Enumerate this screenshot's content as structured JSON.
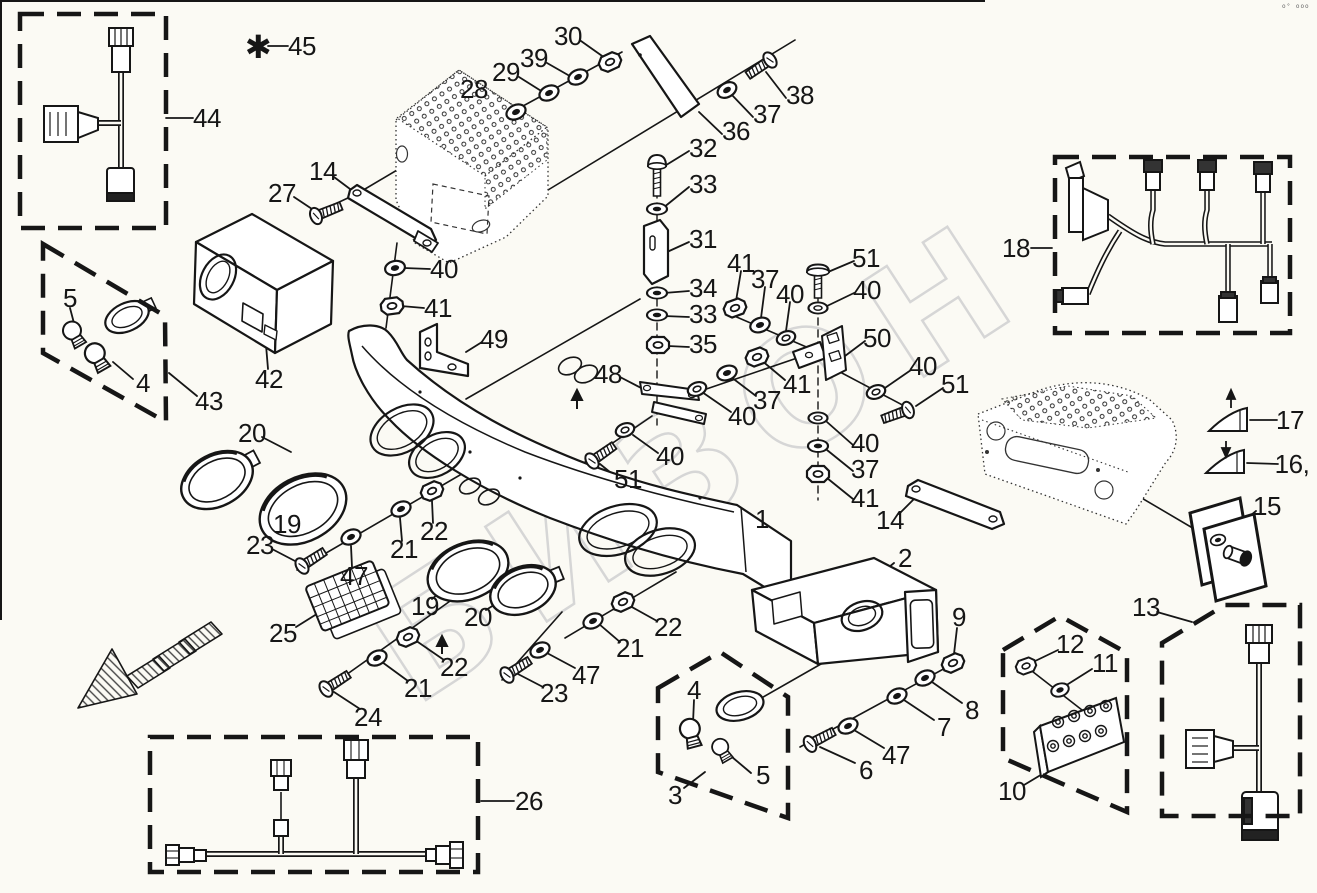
{
  "document": {
    "type": "exploded-parts-diagram",
    "corner_mark": "o° ooo"
  },
  "colors": {
    "ink": "#161616",
    "watermark": "#d6d6d6",
    "background": "#fbfaf4"
  },
  "watermark": {
    "text": "БИЗОН"
  },
  "callouts": [
    {
      "text": "✱",
      "x": 258,
      "y": 47,
      "size": 32
    },
    {
      "text": "45",
      "x": 302,
      "y": 46
    },
    {
      "text": "44",
      "x": 207,
      "y": 118
    },
    {
      "text": "30",
      "x": 568,
      "y": 36
    },
    {
      "text": "39",
      "x": 534,
      "y": 58
    },
    {
      "text": "29",
      "x": 506,
      "y": 72
    },
    {
      "text": "28",
      "x": 474,
      "y": 89
    },
    {
      "text": "38",
      "x": 800,
      "y": 95
    },
    {
      "text": "37",
      "x": 767,
      "y": 114
    },
    {
      "text": "36",
      "x": 736,
      "y": 131
    },
    {
      "text": "32",
      "x": 703,
      "y": 148
    },
    {
      "text": "33",
      "x": 703,
      "y": 184
    },
    {
      "text": "31",
      "x": 703,
      "y": 239
    },
    {
      "text": "27",
      "x": 282,
      "y": 193
    },
    {
      "text": "14",
      "x": 323,
      "y": 171
    },
    {
      "text": "40",
      "x": 444,
      "y": 269
    },
    {
      "text": "41",
      "x": 438,
      "y": 308
    },
    {
      "text": "34",
      "x": 703,
      "y": 288
    },
    {
      "text": "33",
      "x": 703,
      "y": 314
    },
    {
      "text": "35",
      "x": 703,
      "y": 344
    },
    {
      "text": "41",
      "x": 741,
      "y": 263
    },
    {
      "text": "37",
      "x": 765,
      "y": 279
    },
    {
      "text": "40",
      "x": 790,
      "y": 294
    },
    {
      "text": "51",
      "x": 866,
      "y": 258
    },
    {
      "text": "40",
      "x": 867,
      "y": 290
    },
    {
      "text": "50",
      "x": 877,
      "y": 338
    },
    {
      "text": "48",
      "x": 608,
      "y": 374
    },
    {
      "text": "41",
      "x": 797,
      "y": 384
    },
    {
      "text": "37",
      "x": 767,
      "y": 400
    },
    {
      "text": "40",
      "x": 742,
      "y": 416
    },
    {
      "text": "40",
      "x": 923,
      "y": 366
    },
    {
      "text": "51",
      "x": 955,
      "y": 384
    },
    {
      "text": "40",
      "x": 865,
      "y": 443
    },
    {
      "text": "37",
      "x": 865,
      "y": 469
    },
    {
      "text": "41",
      "x": 865,
      "y": 498
    },
    {
      "text": "40",
      "x": 670,
      "y": 456
    },
    {
      "text": "51",
      "x": 628,
      "y": 479
    },
    {
      "text": "49",
      "x": 494,
      "y": 339
    },
    {
      "text": "1",
      "x": 762,
      "y": 519
    },
    {
      "text": "42",
      "x": 269,
      "y": 379
    },
    {
      "text": "43",
      "x": 209,
      "y": 401
    },
    {
      "text": "5",
      "x": 70,
      "y": 298
    },
    {
      "text": "4",
      "x": 143,
      "y": 383
    },
    {
      "text": "18",
      "x": 1016,
      "y": 248
    },
    {
      "text": "17",
      "x": 1290,
      "y": 420
    },
    {
      "text": "16,",
      "x": 1292,
      "y": 464
    },
    {
      "text": "15",
      "x": 1267,
      "y": 506
    },
    {
      "text": "13",
      "x": 1146,
      "y": 607
    },
    {
      "text": "12",
      "x": 1070,
      "y": 644
    },
    {
      "text": "11",
      "x": 1105,
      "y": 663
    },
    {
      "text": "10",
      "x": 1012,
      "y": 791
    },
    {
      "text": "2",
      "x": 905,
      "y": 558
    },
    {
      "text": "9",
      "x": 959,
      "y": 617
    },
    {
      "text": "8",
      "x": 972,
      "y": 710
    },
    {
      "text": "7",
      "x": 944,
      "y": 727
    },
    {
      "text": "47",
      "x": 896,
      "y": 755
    },
    {
      "text": "6",
      "x": 866,
      "y": 770
    },
    {
      "text": "4",
      "x": 694,
      "y": 690
    },
    {
      "text": "5",
      "x": 763,
      "y": 775
    },
    {
      "text": "3",
      "x": 675,
      "y": 795
    },
    {
      "text": "14",
      "x": 890,
      "y": 520
    },
    {
      "text": "20",
      "x": 252,
      "y": 433
    },
    {
      "text": "19",
      "x": 287,
      "y": 524
    },
    {
      "text": "23",
      "x": 260,
      "y": 545
    },
    {
      "text": "47",
      "x": 354,
      "y": 576
    },
    {
      "text": "21",
      "x": 404,
      "y": 549
    },
    {
      "text": "22",
      "x": 434,
      "y": 531
    },
    {
      "text": "25",
      "x": 283,
      "y": 633
    },
    {
      "text": "19",
      "x": 425,
      "y": 606
    },
    {
      "text": "20",
      "x": 478,
      "y": 617
    },
    {
      "text": "22",
      "x": 454,
      "y": 667
    },
    {
      "text": "21",
      "x": 418,
      "y": 688
    },
    {
      "text": "24",
      "x": 368,
      "y": 717
    },
    {
      "text": "23",
      "x": 554,
      "y": 693
    },
    {
      "text": "47",
      "x": 586,
      "y": 675
    },
    {
      "text": "22",
      "x": 668,
      "y": 627
    },
    {
      "text": "21",
      "x": 630,
      "y": 648
    },
    {
      "text": "26",
      "x": 529,
      "y": 801
    }
  ]
}
